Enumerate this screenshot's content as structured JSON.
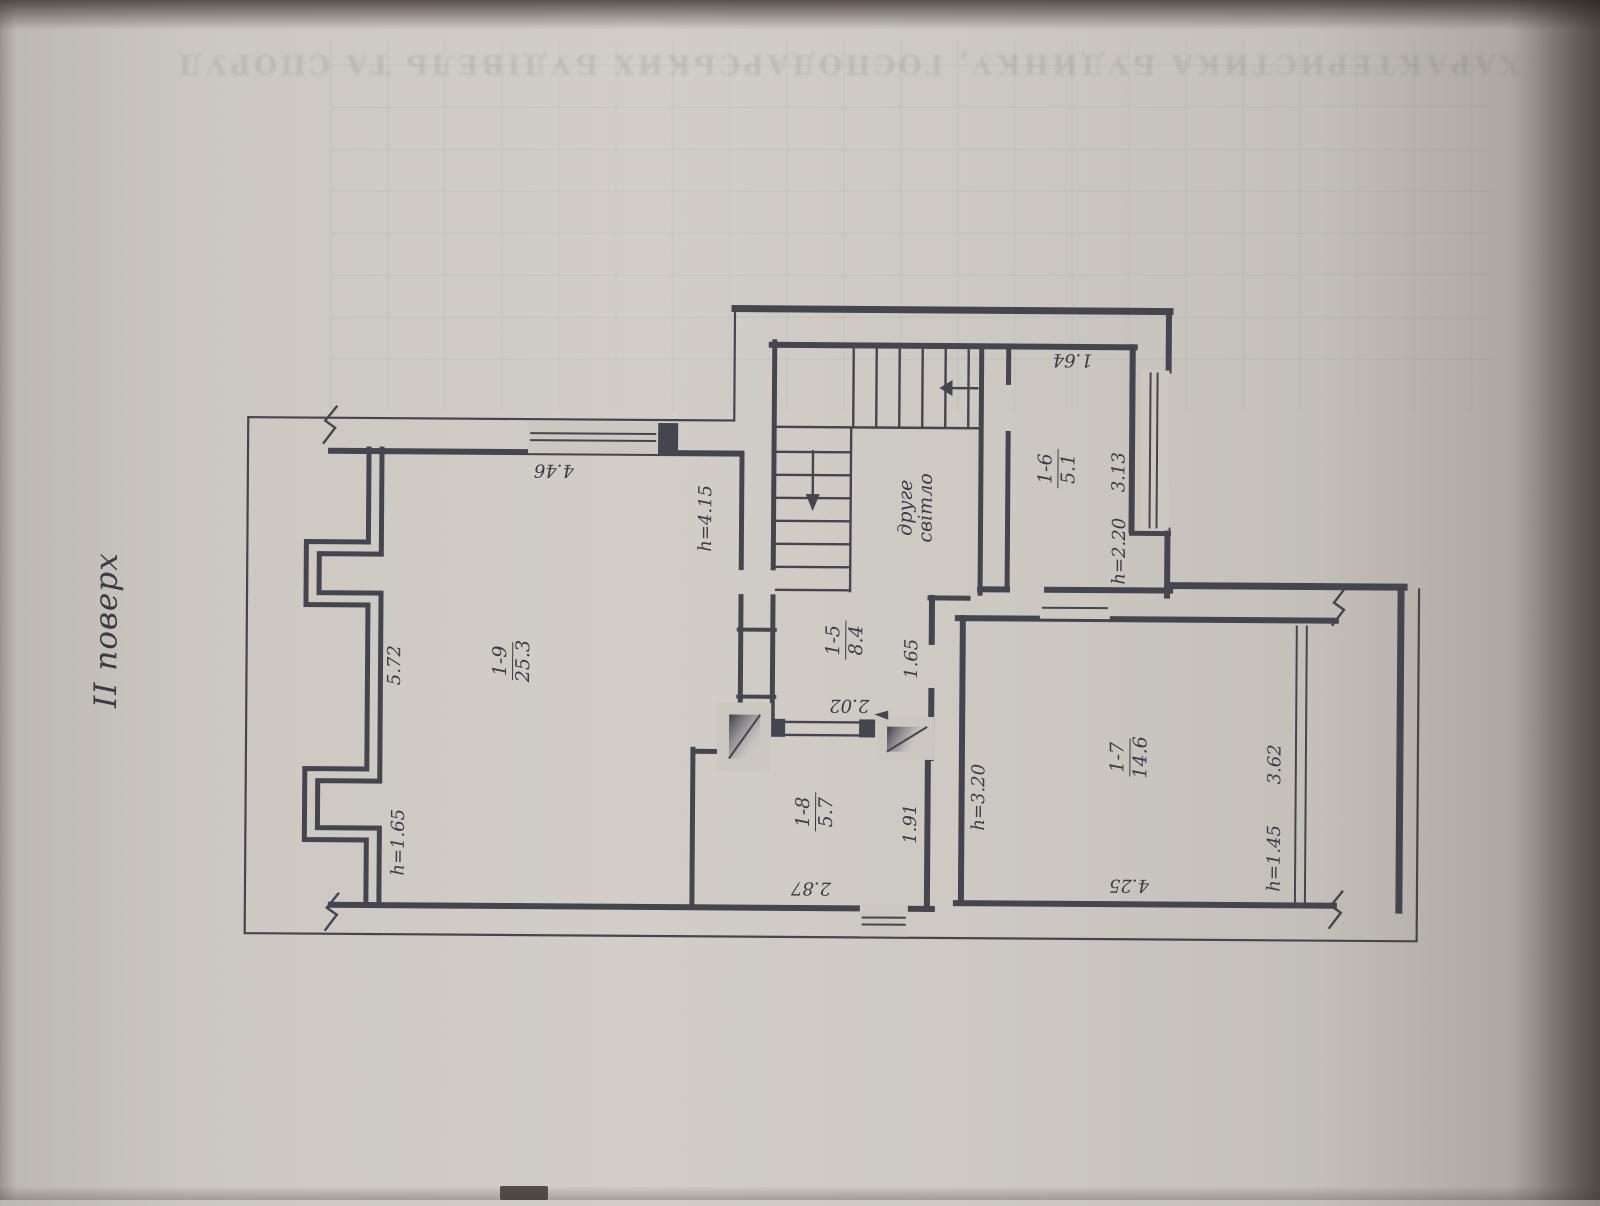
{
  "page": {
    "floor_title": "II поверх",
    "bleed_header": "ХАРАКТЕРИСТИКА БУДИНКУ, ГОСПОДАРСЬКИХ БУДІВЕЛЬ ТА СПОРУД"
  },
  "plan": {
    "rooms": [
      {
        "id": "1-9",
        "area": "25.3"
      },
      {
        "id": "1-5",
        "area": "8.4"
      },
      {
        "id": "1-6",
        "area": "5.1"
      },
      {
        "id": "1-8",
        "area": "5.7"
      },
      {
        "id": "1-7",
        "area": "14.6"
      }
    ],
    "stair_note": {
      "line1": "друге",
      "line2": "світло"
    },
    "dims": {
      "w_5_72": "5.72",
      "w_4_46": "4.46",
      "h_4_15": "h=4.15",
      "h_1_65": "h=1.65",
      "w_1_64": "1.64",
      "w_3_13": "3.13",
      "h_2_20": "h=2.20",
      "w_1_65": "1.65",
      "w_2_02": "2.02",
      "w_1_91": "1.91",
      "w_2_87": "2.87",
      "h_3_20": "h=3.20",
      "w_4_25": "4.25",
      "w_3_62": "3.62",
      "h_1_45": "h=1.45"
    }
  },
  "colors": {
    "paper": "#ccc8c1",
    "ink": "#45454f"
  }
}
